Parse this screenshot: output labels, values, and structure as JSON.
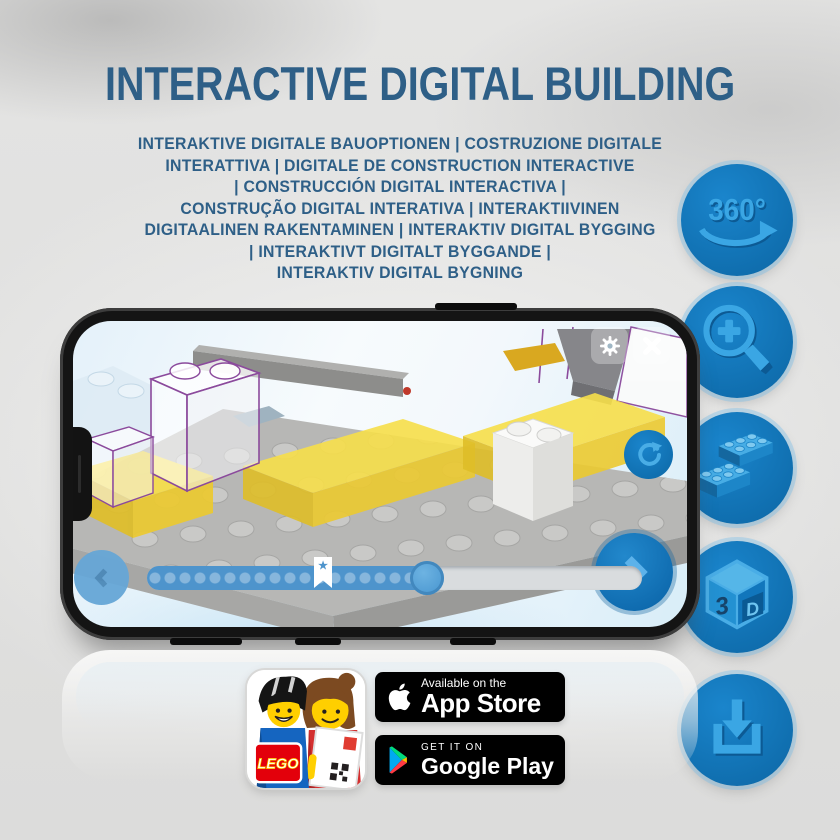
{
  "title": "INTERACTIVE DIGITAL BUILDING",
  "subtitle": {
    "lines": [
      "INTERAKTIVE DIGITALE BAUOPTIONEN | COSTRUZIONE DIGITALE",
      "INTERATTIVA | DIGITALE DE CONSTRUCTION INTERACTIVE",
      "| CONSTRUCCIÓN DIGITAL INTERACTIVA |",
      "CONSTRUÇÃO DIGITAL INTERATIVA | INTERAKTIIVINEN",
      "DIGITAALINEN RAKENTAMINEN | INTERAKTIV DIGITAL BYGGING",
      "| INTERAKTIVT DIGITALT BYGGANDE |",
      "INTERAKTIV DIGITAL BYGNING"
    ]
  },
  "features": {
    "rotate_label": "360°",
    "cube_left": "3",
    "cube_right": "D",
    "icon_names": [
      "360-rotation-icon",
      "zoom-in-icon",
      "lego-brick-icon",
      "3d-cube-icon",
      "download-icon"
    ]
  },
  "badges": {
    "app_store": {
      "line1": "Available on the",
      "line2": "App Store"
    },
    "google_play": {
      "line1": "GET IT ON",
      "line2": "Google Play"
    },
    "lego_logo": "LEGO"
  },
  "colors": {
    "title_blue": "#2e5f87",
    "circle_blue": "#1176bc",
    "icon_blue": "#3aa6e4",
    "lego_yellow": "#f7df4a",
    "outline_purple": "#8b4a9c"
  }
}
